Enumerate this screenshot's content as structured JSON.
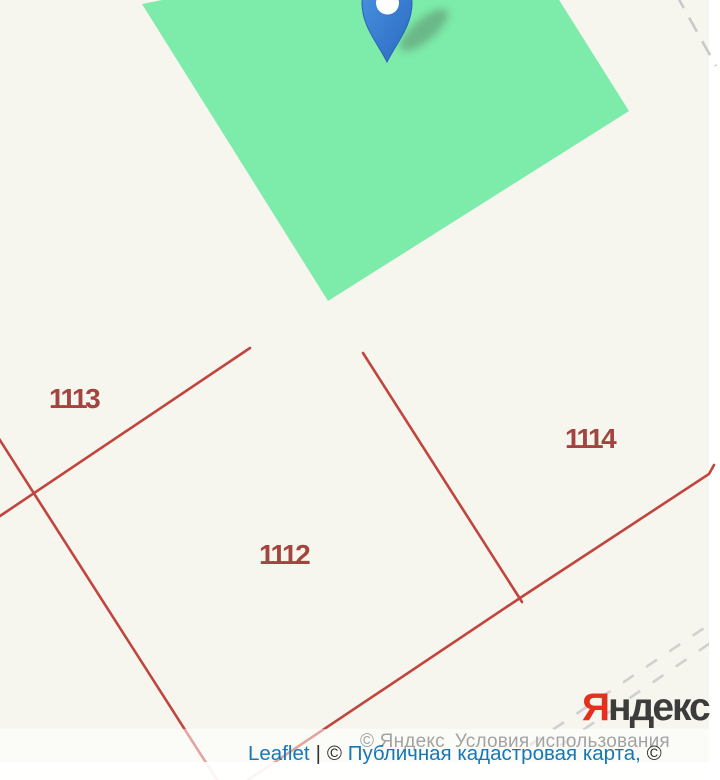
{
  "map": {
    "background_color": "#f6f6ee",
    "tile_gap_color": "#ffffff",
    "selected_parcel_fill": "#7deba9",
    "boundary_line_color": "#c1453f",
    "road_dash_color": "#d0d0d0",
    "marker_color": "#3579cf",
    "parcels": [
      {
        "label": "1113"
      },
      {
        "label": "1112"
      },
      {
        "label": "1114"
      }
    ]
  },
  "watermark": {
    "brand_first_letter": "Я",
    "brand_rest": "ндекс"
  },
  "attribution": {
    "yandex_copyright": "© Яндекс",
    "yandex_terms_link": "Условия использования",
    "leaflet_link": "Leaflet",
    "separator": "|",
    "pkk_copyright_symbol": "©",
    "pkk_link": "Публичная кадастровая карта,",
    "trailing_copyright": "©"
  }
}
